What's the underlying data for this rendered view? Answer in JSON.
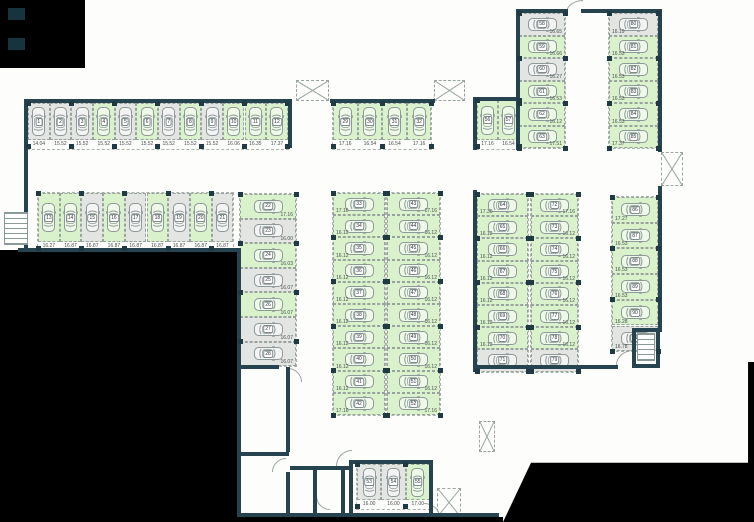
{
  "palette": {
    "available_fill": "#d9f2cb",
    "occupied_fill": "#e3e5e2",
    "wall_color": "#26444f",
    "exterior_color": "#000000",
    "line_color": "#98a5a2"
  },
  "icons": {
    "car": "car-top-view-outline",
    "stairs": "striped-stair-treads",
    "shaft": "dashed-box-x-cross",
    "door": "quarter-circle-swing-arc"
  },
  "floorplan": {
    "runs": [
      {
        "name": "row-top-left",
        "orient": "v",
        "x": 28,
        "y": 103,
        "cw": 21.65,
        "ch": 37,
        "labels": "below",
        "spaces": [
          {
            "n": "1",
            "area": "14.04",
            "state": "occupied"
          },
          {
            "n": "2",
            "area": "15.52",
            "state": "occupied"
          },
          {
            "n": "3",
            "area": "15.52",
            "state": "occupied"
          },
          {
            "n": "4",
            "area": "15.52",
            "state": "available"
          },
          {
            "n": "5",
            "area": "15.52",
            "state": "occupied"
          },
          {
            "n": "6",
            "area": "15.52",
            "state": "available"
          },
          {
            "n": "7",
            "area": "15.52",
            "state": "occupied"
          },
          {
            "n": "8",
            "area": "15.52",
            "state": "available"
          },
          {
            "n": "9",
            "area": "15.52",
            "state": "occupied"
          },
          {
            "n": "10",
            "area": "16.06",
            "state": "available"
          },
          {
            "n": "11",
            "area": "16.35",
            "state": "available"
          },
          {
            "n": "12",
            "area": "17.37",
            "state": "available"
          }
        ]
      },
      {
        "name": "row-second-left",
        "orient": "v",
        "x": 38,
        "y": 193,
        "cw": 21.7,
        "ch": 49,
        "labels": "below",
        "spaces": [
          {
            "n": "13",
            "area": "16.27",
            "state": "available"
          },
          {
            "n": "14",
            "area": "16.87",
            "state": "available"
          },
          {
            "n": "15",
            "area": "16.87",
            "state": "occupied"
          },
          {
            "n": "16",
            "area": "16.87",
            "state": "available"
          },
          {
            "n": "17",
            "area": "16.87",
            "state": "occupied"
          },
          {
            "n": "18",
            "area": "16.87",
            "state": "available"
          },
          {
            "n": "19",
            "area": "16.87",
            "state": "occupied"
          },
          {
            "n": "20",
            "area": "16.87",
            "state": "available"
          },
          {
            "n": "21",
            "area": "16.87",
            "state": "occupied"
          }
        ]
      },
      {
        "name": "column-left-inner",
        "orient": "h",
        "x": 240,
        "y": 194,
        "cw": 56,
        "ch": 24.6,
        "labels": "right",
        "spaces": [
          {
            "n": "22",
            "area": "17.16",
            "state": "available"
          },
          {
            "n": "23",
            "area": "16.00",
            "state": "occupied"
          },
          {
            "n": "24",
            "area": "16.03",
            "state": "available"
          },
          {
            "n": "25",
            "area": "16.07",
            "state": "occupied"
          },
          {
            "n": "26",
            "area": "16.07",
            "state": "available"
          },
          {
            "n": "27",
            "area": "16.07",
            "state": "occupied"
          },
          {
            "n": "28",
            "area": "16.07",
            "state": "occupied"
          }
        ]
      },
      {
        "name": "group-top-middle",
        "orient": "v",
        "x": 333,
        "y": 103,
        "cw": 24.6,
        "ch": 37,
        "labels": "below",
        "spaces": [
          {
            "n": "29",
            "area": "17.16",
            "state": "available"
          },
          {
            "n": "30",
            "area": "16.54",
            "state": "available"
          },
          {
            "n": "31",
            "area": "16.54",
            "state": "available"
          },
          {
            "n": "32",
            "area": "17.16",
            "state": "available"
          }
        ]
      },
      {
        "name": "column-middle-west",
        "orient": "h",
        "x": 333,
        "y": 193,
        "cw": 52,
        "ch": 22.2,
        "labels": "left",
        "spaces": [
          {
            "n": "33",
            "area": "17.16",
            "state": "available"
          },
          {
            "n": "34",
            "area": "16.12",
            "state": "available"
          },
          {
            "n": "35",
            "area": "16.12",
            "state": "available"
          },
          {
            "n": "36",
            "area": "16.12",
            "state": "available"
          },
          {
            "n": "37",
            "area": "16.12",
            "state": "available"
          },
          {
            "n": "38",
            "area": "16.12",
            "state": "available"
          },
          {
            "n": "39",
            "area": "16.12",
            "state": "available"
          },
          {
            "n": "40",
            "area": "16.12",
            "state": "available"
          },
          {
            "n": "41",
            "area": "16.12",
            "state": "available"
          },
          {
            "n": "42",
            "area": "17.16",
            "state": "available"
          }
        ]
      },
      {
        "name": "column-middle-east",
        "orient": "h",
        "x": 387,
        "y": 193,
        "cw": 53,
        "ch": 22.2,
        "labels": "right",
        "spaces": [
          {
            "n": "43",
            "area": "17.16",
            "state": "available"
          },
          {
            "n": "44",
            "area": "16.12",
            "state": "available"
          },
          {
            "n": "45",
            "area": "16.12",
            "state": "available"
          },
          {
            "n": "46",
            "area": "16.12",
            "state": "available"
          },
          {
            "n": "47",
            "area": "16.12",
            "state": "available"
          },
          {
            "n": "48",
            "area": "16.12",
            "state": "available"
          },
          {
            "n": "49",
            "area": "16.12",
            "state": "available"
          },
          {
            "n": "50",
            "area": "16.12",
            "state": "available"
          },
          {
            "n": "51",
            "area": "16.12",
            "state": "available"
          },
          {
            "n": "52",
            "area": "17.16",
            "state": "available"
          }
        ]
      },
      {
        "name": "group-bottom-middle",
        "orient": "v",
        "x": 357,
        "y": 464,
        "cw": 24.3,
        "ch": 36,
        "labels": "below",
        "spaces": [
          {
            "n": "53",
            "area": "16.00",
            "state": "occupied"
          },
          {
            "n": "54",
            "area": "16.00",
            "state": "occupied"
          },
          {
            "n": "55",
            "area": "17.00",
            "state": "available"
          }
        ]
      },
      {
        "name": "pair-top-right",
        "orient": "v",
        "x": 477,
        "y": 100,
        "cw": 21,
        "ch": 40,
        "labels": "below",
        "spaces": [
          {
            "n": "56",
            "area": "17.16",
            "state": "available"
          },
          {
            "n": "57",
            "area": "16.54",
            "state": "available"
          }
        ]
      },
      {
        "name": "column-topright-west",
        "orient": "h",
        "x": 519,
        "y": 13,
        "cw": 46,
        "ch": 22.5,
        "labels": "right",
        "spaces": [
          {
            "n": "58",
            "area": "16.65",
            "state": "occupied"
          },
          {
            "n": "59",
            "area": "16.66",
            "state": "available"
          },
          {
            "n": "60",
            "area": "16.27",
            "state": "occupied"
          },
          {
            "n": "61",
            "area": "16.53",
            "state": "available"
          },
          {
            "n": "62",
            "area": "16.12",
            "state": "available"
          },
          {
            "n": "63",
            "area": "17.51",
            "state": "available"
          }
        ]
      },
      {
        "name": "column-right-west",
        "orient": "h",
        "x": 477,
        "y": 194,
        "cw": 51,
        "ch": 22.2,
        "labels": "left",
        "spaces": [
          {
            "n": "64",
            "area": "17.30",
            "state": "available"
          },
          {
            "n": "65",
            "area": "16.12",
            "state": "available"
          },
          {
            "n": "66",
            "area": "16.12",
            "state": "available"
          },
          {
            "n": "67",
            "area": "16.12",
            "state": "available"
          },
          {
            "n": "68",
            "area": "16.12",
            "state": "available"
          },
          {
            "n": "69",
            "area": "16.12",
            "state": "available"
          },
          {
            "n": "70",
            "area": "16.12",
            "state": "available"
          },
          {
            "n": "71",
            "area": "16.81",
            "state": "occupied"
          }
        ]
      },
      {
        "name": "column-right-east",
        "orient": "h",
        "x": 531,
        "y": 194,
        "cw": 47,
        "ch": 22.2,
        "labels": "right",
        "spaces": [
          {
            "n": "72",
            "area": "17.16",
            "state": "available"
          },
          {
            "n": "73",
            "area": "16.12",
            "state": "available"
          },
          {
            "n": "74",
            "area": "16.12",
            "state": "available"
          },
          {
            "n": "75",
            "area": "16.12",
            "state": "available"
          },
          {
            "n": "76",
            "area": "16.12",
            "state": "available"
          },
          {
            "n": "77",
            "area": "16.12",
            "state": "available"
          },
          {
            "n": "78",
            "area": "16.12",
            "state": "available"
          },
          {
            "n": "79",
            "area": "16.81",
            "state": "occupied"
          }
        ]
      },
      {
        "name": "column-topright-east",
        "orient": "h",
        "x": 609,
        "y": 13,
        "cw": 49,
        "ch": 22.5,
        "labels": "left",
        "spaces": [
          {
            "n": "80",
            "area": "16.19",
            "state": "occupied"
          },
          {
            "n": "81",
            "area": "16.53",
            "state": "available"
          },
          {
            "n": "82",
            "area": "16.53",
            "state": "available"
          },
          {
            "n": "83",
            "area": "16.53",
            "state": "available"
          },
          {
            "n": "84",
            "area": "16.53",
            "state": "available"
          },
          {
            "n": "85",
            "area": "17.37",
            "state": "available"
          }
        ]
      },
      {
        "name": "column-far-right",
        "orient": "h",
        "x": 612,
        "y": 197,
        "cw": 46,
        "ch": 25.7,
        "labels": "left",
        "spaces": [
          {
            "n": "86",
            "area": "17.27",
            "state": "available"
          },
          {
            "n": "87",
            "area": "16.53",
            "state": "available"
          },
          {
            "n": "88",
            "area": "16.53",
            "state": "available"
          },
          {
            "n": "89",
            "area": "16.53",
            "state": "available"
          },
          {
            "n": "90",
            "area": "16.28",
            "state": "available"
          },
          {
            "n": "91",
            "area": "16.78",
            "state": "occupied"
          }
        ]
      }
    ]
  }
}
